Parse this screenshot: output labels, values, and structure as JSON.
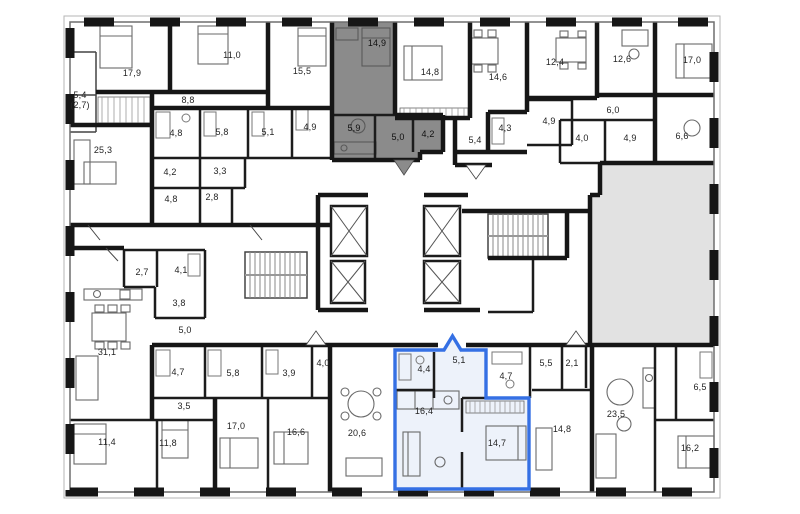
{
  "floor_plan": {
    "title": "residential-floor-plan",
    "background_color": "#ffffff",
    "wall_color": "#161616",
    "selected_unit": {
      "outline_color": "#3570e4",
      "fill_color": "#edf2fa",
      "rooms": [
        {
          "area": "4,4",
          "x": 424,
          "y": 369
        },
        {
          "area": "5,1",
          "x": 459,
          "y": 360
        },
        {
          "area": "16,4",
          "x": 424,
          "y": 411
        },
        {
          "area": "14,7",
          "x": 497,
          "y": 443
        }
      ]
    },
    "shaded_unit": {
      "fill_color": "#8b8b8b",
      "rooms": [
        {
          "area": "14,9",
          "x": 377,
          "y": 43
        },
        {
          "area": "5,9",
          "x": 354,
          "y": 128
        },
        {
          "area": "5,0",
          "x": 398,
          "y": 137
        },
        {
          "area": "4,2",
          "x": 428,
          "y": 134
        }
      ]
    },
    "empty_area": {
      "fill_color": "#e2e2e2"
    },
    "core": {
      "elevator_shafts": 4,
      "staircases": 2
    },
    "other_rooms": [
      {
        "area": "17,9",
        "x": 132,
        "y": 73
      },
      {
        "area": "5,4\n(2,7)",
        "x": 80,
        "y": 100
      },
      {
        "area": "8,8",
        "x": 188,
        "y": 100
      },
      {
        "area": "11,0",
        "x": 232,
        "y": 55
      },
      {
        "area": "15,5",
        "x": 302,
        "y": 71
      },
      {
        "area": "25,3",
        "x": 103,
        "y": 150
      },
      {
        "area": "4,8",
        "x": 176,
        "y": 133
      },
      {
        "area": "5,8",
        "x": 222,
        "y": 132
      },
      {
        "area": "5,1",
        "x": 268,
        "y": 132
      },
      {
        "area": "4,9",
        "x": 310,
        "y": 127
      },
      {
        "area": "4,2",
        "x": 170,
        "y": 172
      },
      {
        "area": "3,3",
        "x": 220,
        "y": 171
      },
      {
        "area": "4,8",
        "x": 171,
        "y": 199
      },
      {
        "area": "2,8",
        "x": 212,
        "y": 197
      },
      {
        "area": "14,8",
        "x": 430,
        "y": 72
      },
      {
        "area": "14,6",
        "x": 498,
        "y": 77
      },
      {
        "area": "4,3",
        "x": 505,
        "y": 128
      },
      {
        "area": "5,4",
        "x": 475,
        "y": 140
      },
      {
        "area": "4,9",
        "x": 549,
        "y": 121
      },
      {
        "area": "12,4",
        "x": 555,
        "y": 62
      },
      {
        "area": "12,6",
        "x": 622,
        "y": 59
      },
      {
        "area": "17,0",
        "x": 692,
        "y": 60
      },
      {
        "area": "6,0",
        "x": 613,
        "y": 110
      },
      {
        "area": "4,0",
        "x": 582,
        "y": 138
      },
      {
        "area": "4,9",
        "x": 630,
        "y": 138
      },
      {
        "area": "6,6",
        "x": 682,
        "y": 136
      },
      {
        "area": "2,7",
        "x": 142,
        "y": 272
      },
      {
        "area": "4,1",
        "x": 181,
        "y": 270
      },
      {
        "area": "3,8",
        "x": 179,
        "y": 303
      },
      {
        "area": "5,0",
        "x": 185,
        "y": 330
      },
      {
        "area": "31,1",
        "x": 107,
        "y": 352
      },
      {
        "area": "4,7",
        "x": 178,
        "y": 372
      },
      {
        "area": "5,8",
        "x": 233,
        "y": 373
      },
      {
        "area": "3,9",
        "x": 289,
        "y": 373
      },
      {
        "area": "3,5",
        "x": 184,
        "y": 406
      },
      {
        "area": "11,4",
        "x": 107,
        "y": 442
      },
      {
        "area": "11,8",
        "x": 168,
        "y": 443
      },
      {
        "area": "17,0",
        "x": 236,
        "y": 426
      },
      {
        "area": "16,6",
        "x": 296,
        "y": 432
      },
      {
        "area": "4,0",
        "x": 323,
        "y": 363
      },
      {
        "area": "20,6",
        "x": 357,
        "y": 433
      },
      {
        "area": "4,7",
        "x": 506,
        "y": 376
      },
      {
        "area": "5,5",
        "x": 546,
        "y": 363
      },
      {
        "area": "2,1",
        "x": 572,
        "y": 363
      },
      {
        "area": "14,8",
        "x": 562,
        "y": 429
      },
      {
        "area": "23,5",
        "x": 616,
        "y": 414
      },
      {
        "area": "6,5",
        "x": 700,
        "y": 387
      },
      {
        "area": "16,2",
        "x": 690,
        "y": 448
      }
    ]
  }
}
